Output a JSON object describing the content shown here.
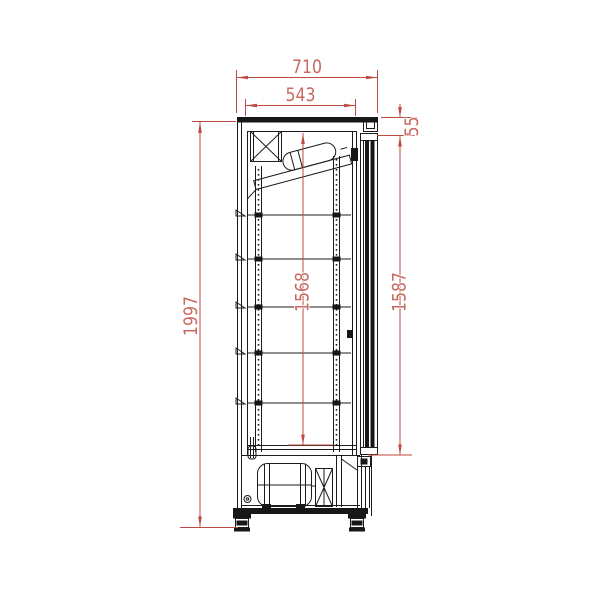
{
  "drawing": {
    "name": "upright-glass-door-cooler-side-section",
    "dimensions": {
      "overall_depth_mm": "710",
      "inner_depth_mm": "543",
      "top_frame_mm": "55",
      "overall_height_mm": "1997",
      "inner_height_mm": "1568",
      "door_height_mm": "1587"
    },
    "shelf_count": 5,
    "colors": {
      "dimension_line": "#bf4a41",
      "dimension_text": "#c9685e",
      "outline": "#1c1c1c",
      "background": "#ffffff"
    }
  }
}
